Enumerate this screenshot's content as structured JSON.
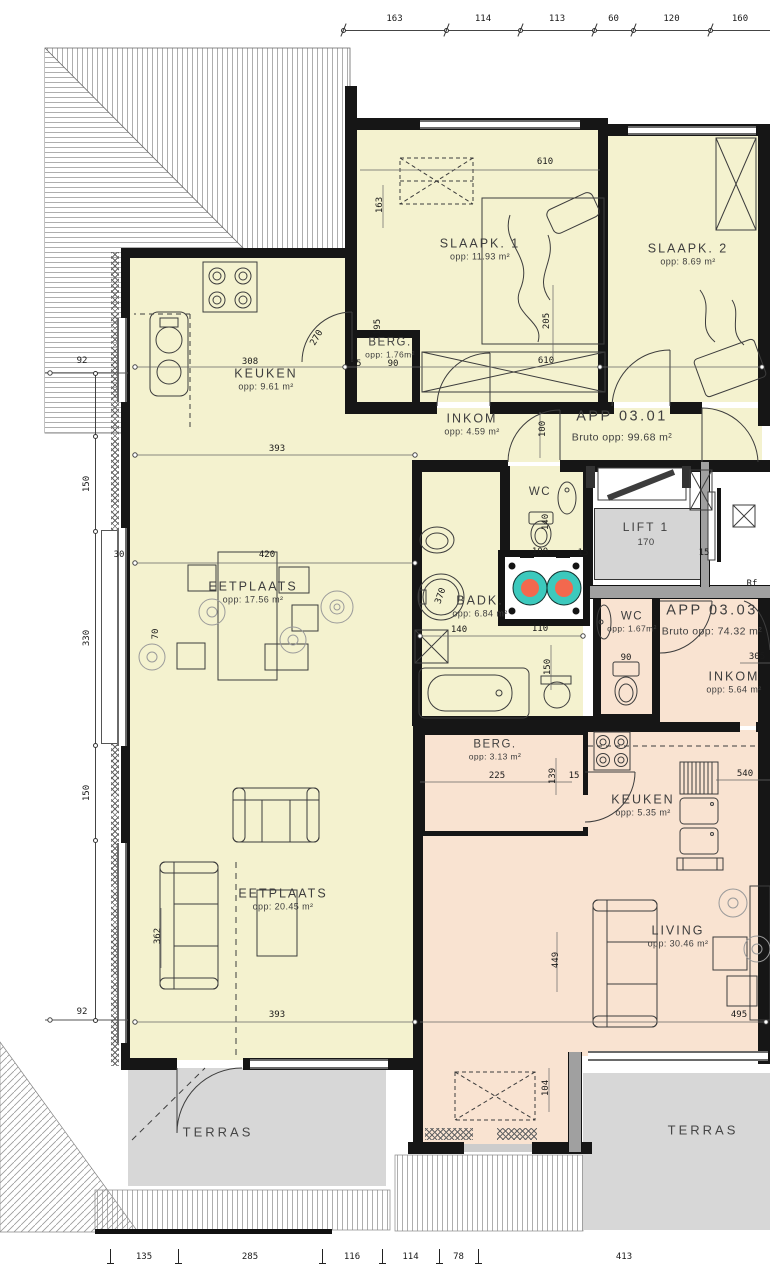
{
  "colors": {
    "apartment_0301_fill": "#f4f2cf",
    "apartment_0303_fill": "#f9e3d1",
    "terrace_fill": "#d7d7d7",
    "wall": "#161616",
    "washer_drum_teal": "#3cc9bd",
    "washer_core_orange": "#f3684e"
  },
  "rooms": [
    {
      "id": "slaapk-1",
      "label": "SLAAPK. 1",
      "area": "opp: 11.93 m²",
      "x": 480,
      "y": 249
    },
    {
      "id": "slaapk-2",
      "label": "SLAAPK. 2",
      "area": "opp: 8.69 m²",
      "x": 688,
      "y": 254
    },
    {
      "id": "berg-1",
      "label": "BERG.",
      "area": "opp: 1.76m²",
      "x": 390,
      "y": 348,
      "cls": "small"
    },
    {
      "id": "keuken-1",
      "label": "KEUKEN",
      "area": "opp: 9.61 m²",
      "x": 266,
      "y": 379
    },
    {
      "id": "inkom-1",
      "label": "INKOM",
      "area": "opp: 4.59 m²",
      "x": 472,
      "y": 424
    },
    {
      "id": "app-03-01",
      "label": "APP 03.01",
      "area": "Bruto opp: 99.68 m²",
      "x": 622,
      "y": 426,
      "cls": "app"
    },
    {
      "id": "wc-1",
      "label": "WC",
      "area": "",
      "x": 540,
      "y": 492,
      "cls": "small"
    },
    {
      "id": "lift-1",
      "label": "LIFT 1",
      "area": "170",
      "x": 646,
      "y": 534,
      "cls": "lift"
    },
    {
      "id": "badk",
      "label": "BADK.",
      "area": "opp: 6.84 m²",
      "x": 480,
      "y": 606
    },
    {
      "id": "eetplaats-1",
      "label": "EETPLAATS",
      "area": "opp: 17.56 m²",
      "x": 253,
      "y": 592
    },
    {
      "id": "eetplaats-2",
      "label": "EETPLAATS",
      "area": "opp: 20.45 m²",
      "x": 283,
      "y": 899
    },
    {
      "id": "wc-3",
      "label": "WC",
      "area": "opp: 1.67m²",
      "x": 632,
      "y": 622,
      "cls": "small"
    },
    {
      "id": "app-03-03",
      "label": "APP 03.03",
      "area": "Bruto opp: 74.32 m²",
      "x": 712,
      "y": 620,
      "cls": "app"
    },
    {
      "id": "inkom-3",
      "label": "INKOM",
      "area": "opp: 5.64 m²",
      "x": 734,
      "y": 682
    },
    {
      "id": "berg-3",
      "label": "BERG.",
      "area": "opp: 3.13 m²",
      "x": 495,
      "y": 750,
      "cls": "small"
    },
    {
      "id": "keuken-3",
      "label": "KEUKEN",
      "area": "opp: 5.35 m²",
      "x": 643,
      "y": 805
    },
    {
      "id": "living",
      "label": "LIVING",
      "area": "opp: 30.46 m²",
      "x": 678,
      "y": 936
    },
    {
      "id": "terras-left",
      "label": "TERRAS",
      "area": "",
      "x": 218,
      "y": 1132,
      "cls": "terras"
    },
    {
      "id": "terras-right",
      "label": "TERRAS",
      "area": "",
      "x": 703,
      "y": 1130,
      "cls": "terras"
    }
  ],
  "annotations": [
    {
      "t": "610",
      "x": 545,
      "y": 162
    },
    {
      "t": "163",
      "x": 380,
      "y": 205,
      "r": -90
    },
    {
      "t": "195",
      "x": 378,
      "y": 327,
      "r": -90
    },
    {
      "t": "270",
      "x": 317,
      "y": 338,
      "r": -60
    },
    {
      "t": "15",
      "x": 356,
      "y": 364
    },
    {
      "t": "90",
      "x": 393,
      "y": 364
    },
    {
      "t": "308",
      "x": 250,
      "y": 362
    },
    {
      "t": "205",
      "x": 547,
      "y": 321,
      "r": -90
    },
    {
      "t": "610",
      "x": 546,
      "y": 361
    },
    {
      "t": "393",
      "x": 277,
      "y": 449
    },
    {
      "t": "100",
      "x": 543,
      "y": 429,
      "r": -90
    },
    {
      "t": "140",
      "x": 546,
      "y": 522,
      "r": -90
    },
    {
      "t": "100",
      "x": 540,
      "y": 552
    },
    {
      "t": "15",
      "x": 583,
      "y": 553
    },
    {
      "t": "15",
      "x": 704,
      "y": 553
    },
    {
      "t": "420",
      "x": 267,
      "y": 555
    },
    {
      "t": "30",
      "x": 119,
      "y": 555
    },
    {
      "t": "70",
      "x": 156,
      "y": 634,
      "r": -90
    },
    {
      "t": "370",
      "x": 441,
      "y": 596,
      "r": -70
    },
    {
      "t": "140",
      "x": 459,
      "y": 630
    },
    {
      "t": "110",
      "x": 540,
      "y": 629
    },
    {
      "t": "150",
      "x": 548,
      "y": 667,
      "r": -90
    },
    {
      "t": "90",
      "x": 626,
      "y": 658
    },
    {
      "t": "305",
      "x": 757,
      "y": 657
    },
    {
      "t": "Rf",
      "x": 752,
      "y": 584
    },
    {
      "t": "225",
      "x": 497,
      "y": 776
    },
    {
      "t": "139",
      "x": 553,
      "y": 776,
      "r": -90
    },
    {
      "t": "15",
      "x": 574,
      "y": 776
    },
    {
      "t": "540",
      "x": 745,
      "y": 774
    },
    {
      "t": "495",
      "x": 739,
      "y": 1015
    },
    {
      "t": "449",
      "x": 556,
      "y": 960,
      "r": -90
    },
    {
      "t": "362",
      "x": 158,
      "y": 936,
      "r": -90
    },
    {
      "t": "393",
      "x": 277,
      "y": 1015
    },
    {
      "t": "104",
      "x": 546,
      "y": 1088,
      "r": -90
    },
    {
      "t": "92",
      "x": 82,
      "y": 361
    },
    {
      "t": "92",
      "x": 82,
      "y": 1012
    }
  ],
  "dims": {
    "top": {
      "y": 30,
      "ticks": [
        343,
        446,
        520,
        594,
        633,
        710
      ],
      "end": 812,
      "labels": [
        "163",
        "114",
        "113",
        "60",
        "120",
        "160"
      ]
    },
    "bottom": {
      "y": 1257,
      "ticks": [
        110,
        178,
        322,
        382,
        439,
        478
      ],
      "end": 770,
      "labels": [
        "135",
        "285",
        "116",
        "114",
        "78",
        "413"
      ]
    },
    "left": {
      "x": 95,
      "y1": 373,
      "y2": 1020,
      "ticks": [
        373,
        436,
        531,
        745,
        840,
        1020
      ],
      "labels": [
        "",
        "150",
        "330",
        "150",
        ""
      ]
    }
  }
}
